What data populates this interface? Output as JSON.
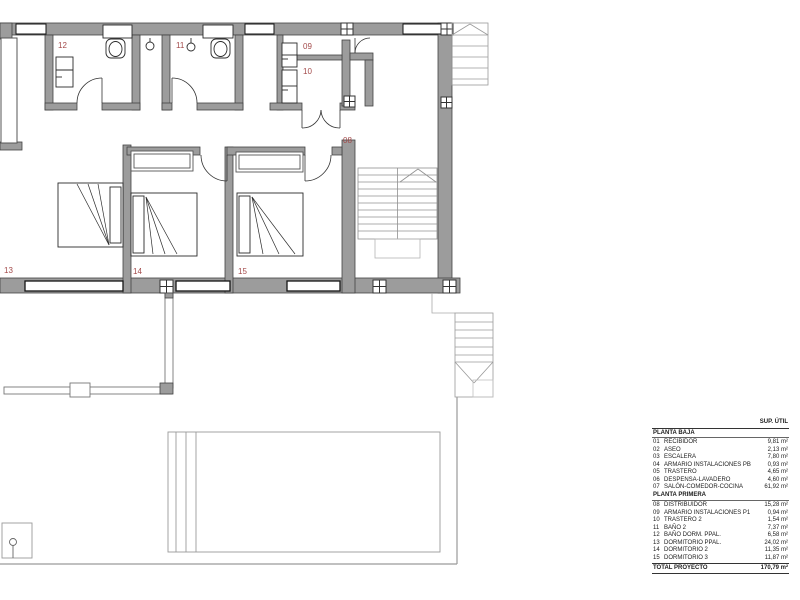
{
  "colors": {
    "wall_fill": "#9c9c9c",
    "wall_stroke": "#434343",
    "window_frame": "#141414",
    "thin_line": "#999999",
    "fixture_line": "#2b2b2b",
    "room_label": "#a34a4a",
    "table_text": "#1d1d1d"
  },
  "plan": {
    "labels": [
      {
        "text": "12"
      },
      {
        "text": "11"
      },
      {
        "text": "09"
      },
      {
        "text": "10"
      },
      {
        "text": "08"
      },
      {
        "text": "13"
      },
      {
        "text": "14"
      },
      {
        "text": "15"
      }
    ]
  },
  "legend": {
    "header": "SUP. ÚTIL",
    "sections": [
      {
        "title": "PLANTA BAJA",
        "rows": [
          [
            "01",
            "RECIBIDOR",
            "9,81 m²"
          ],
          [
            "02",
            "ASEO",
            "2,13 m²"
          ],
          [
            "03",
            "ESCALERA",
            "7,80 m²"
          ],
          [
            "04",
            "ARMARIO INSTALACIONES PB",
            "0,93 m²"
          ],
          [
            "05",
            "TRASTERO",
            "4,65 m²"
          ],
          [
            "06",
            "DESPENSA-LAVADERO",
            "4,60 m²"
          ],
          [
            "07",
            "SALÓN-COMEDOR-COCINA",
            "61,92 m²"
          ]
        ]
      },
      {
        "title": "PLANTA PRIMERA",
        "rows": [
          [
            "08",
            "DISTRIBUIDOR",
            "15,28 m²"
          ],
          [
            "09",
            "ARMARIO INSTALACIONES P1",
            "0,94 m²"
          ],
          [
            "10",
            "TRASTERO 2",
            "1,54 m²"
          ],
          [
            "11",
            "BAÑO 2",
            "7,37 m²"
          ],
          [
            "12",
            "BAÑO DORM. PPAL.",
            "6,58 m²"
          ],
          [
            "13",
            "DORMITORIO PPAL.",
            "24,02 m²"
          ],
          [
            "14",
            "DORMITORIO 2",
            "11,35 m²"
          ],
          [
            "15",
            "DORMITORIO 3",
            "11,87 m²"
          ]
        ]
      }
    ],
    "total": {
      "label": "TOTAL PROYECTO",
      "value": "170,79 m²"
    }
  }
}
